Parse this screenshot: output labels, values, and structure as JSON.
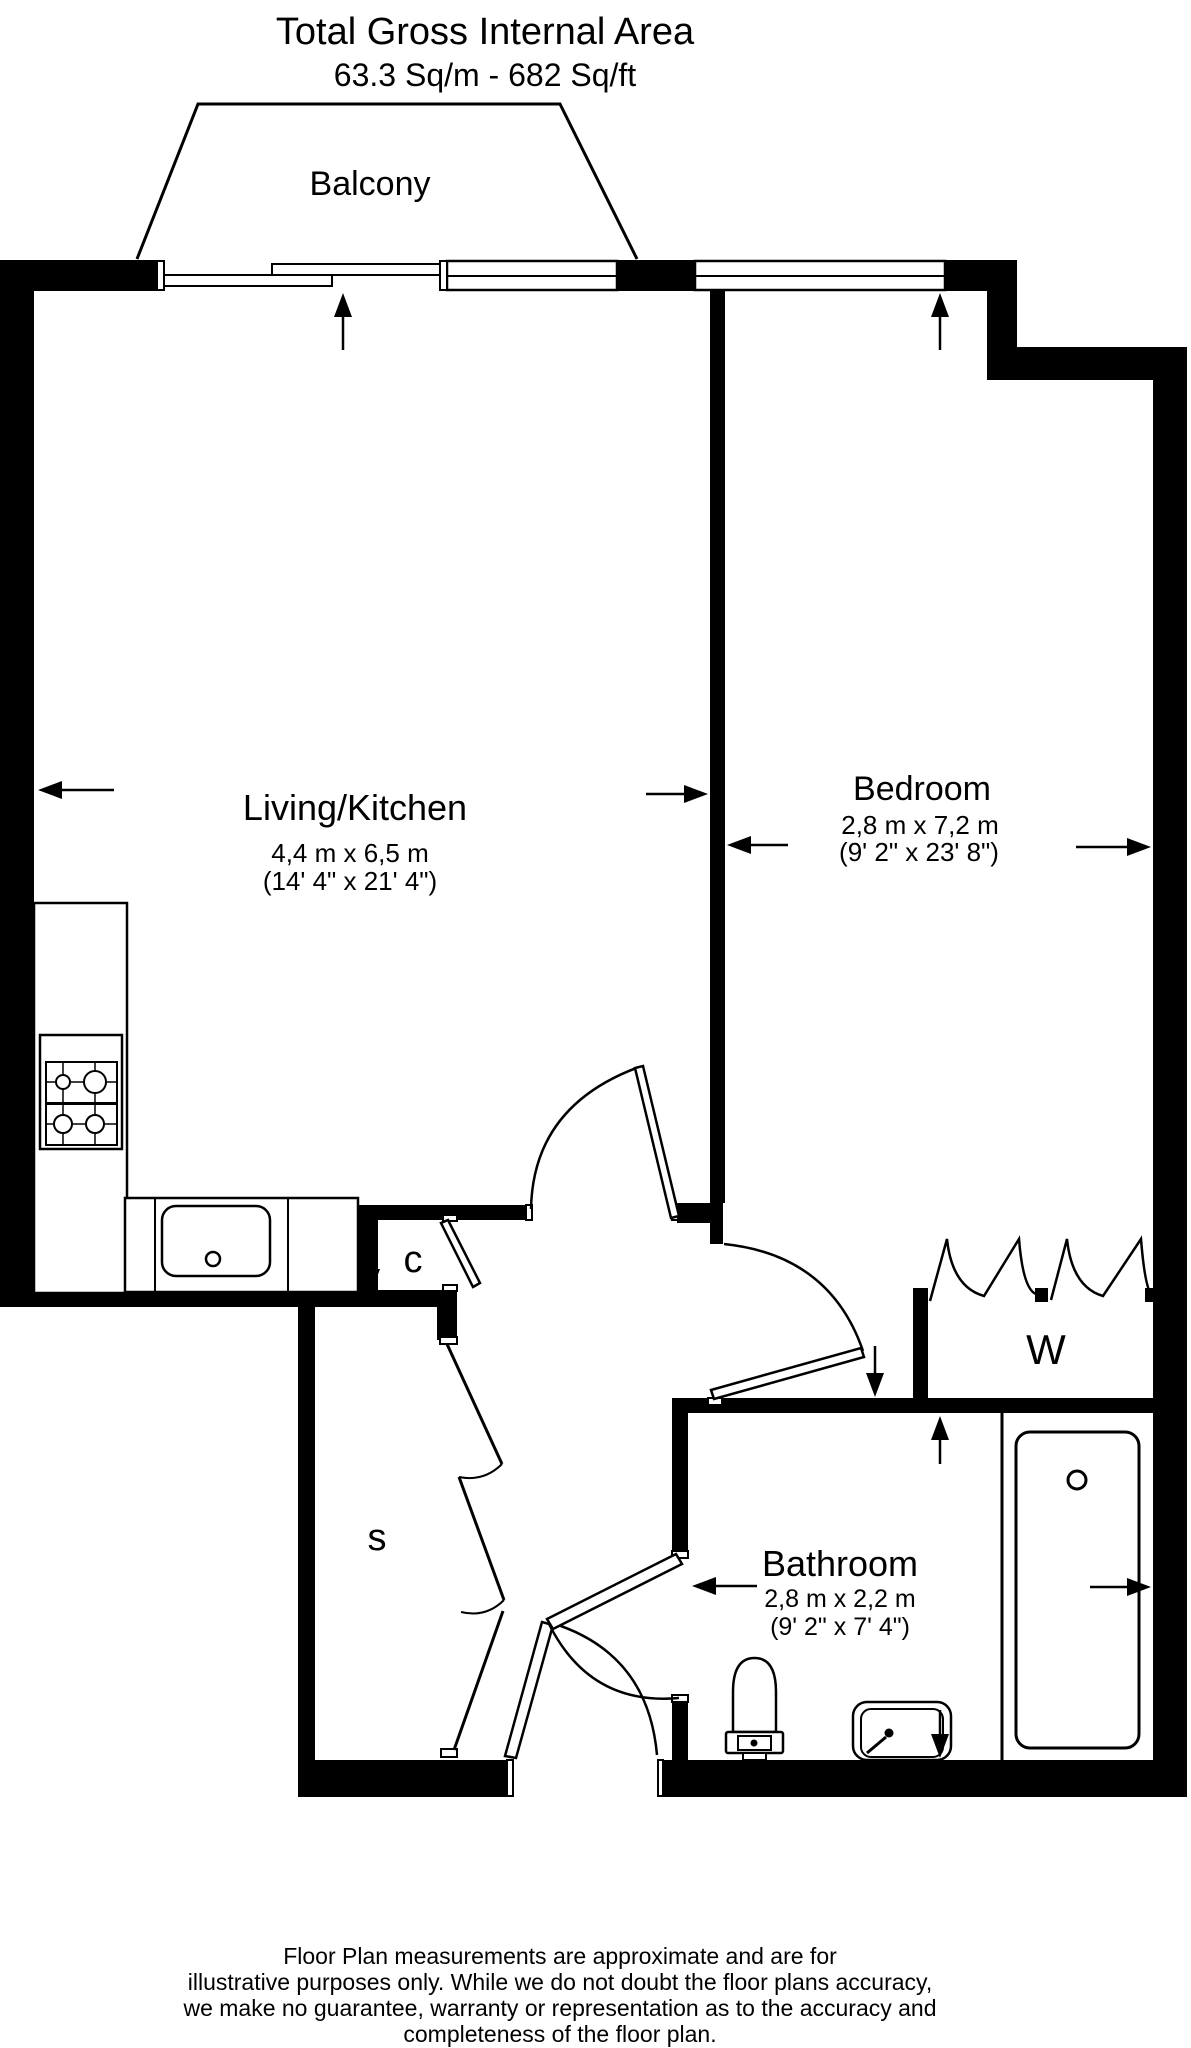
{
  "title": {
    "line1": "Total Gross Internal Area",
    "line2": "63.3 Sq/m - 682 Sq/ft"
  },
  "rooms": {
    "balcony": {
      "name": "Balcony"
    },
    "living_kitchen": {
      "name": "Living/Kitchen",
      "size_metric": "4,4 m x 6,5 m",
      "size_imperial": "(14' 4\" x 21' 4\")"
    },
    "bedroom": {
      "name": "Bedroom",
      "size_metric": "2,8 m x 7,2 m",
      "size_imperial": "(9' 2\" x 23' 8\")"
    },
    "bathroom": {
      "name": "Bathroom",
      "size_metric": "2,8 m x 2,2 m",
      "size_imperial": "(9' 2\" x 7' 4\")"
    },
    "cupboard": {
      "label": "c"
    },
    "store": {
      "label": "s"
    },
    "wardrobe": {
      "label": "W"
    }
  },
  "disclaimer": {
    "line1": "Floor Plan measurements are approximate and are for",
    "line2": "illustrative purposes only.  While we do not doubt the floor plans accuracy,",
    "line3": "we make no guarantee, warranty or representation as to the accuracy and",
    "line4": "completeness of the floor plan."
  },
  "colors": {
    "wall": "#000000",
    "line": "#000000",
    "background": "#ffffff"
  }
}
